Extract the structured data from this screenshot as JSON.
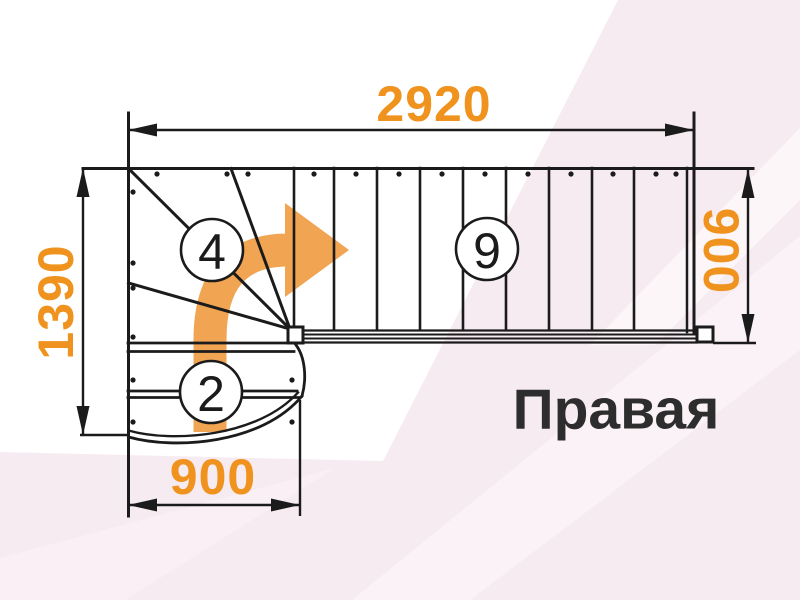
{
  "diagram": {
    "orientation_label": "Правая",
    "dimensions": {
      "total_run_mm": "2920",
      "total_depth_mm": "1390",
      "upper_flight_width_mm": "900",
      "lower_flight_width_mm": "900"
    },
    "step_badges": {
      "winder_steps": "4",
      "upper_flight_steps": "9",
      "lower_flight_steps": "2"
    },
    "icons": {
      "direction_arrow": "curved-arrow-up-to-right"
    },
    "colors": {
      "dimension_text": "#F0921E",
      "arrow": "#F1A452",
      "line": "#1B1B1B",
      "orientation_text": "#2D2D2D",
      "background_pink": "#F7EBF2"
    }
  }
}
